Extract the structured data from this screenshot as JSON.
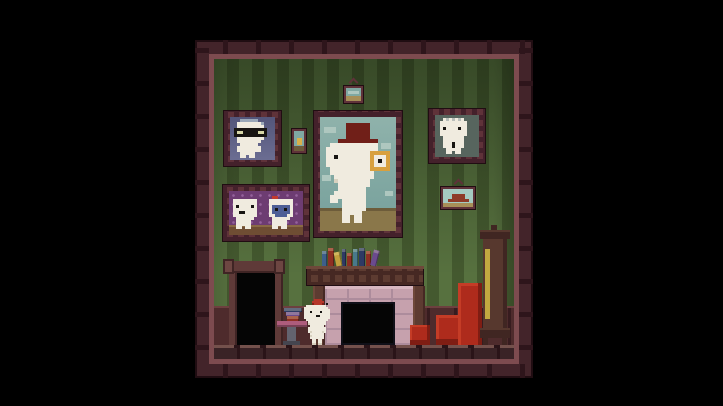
{
  "scene": {
    "game": "pixel-art platformer living room",
    "objects": [
      "room-frame",
      "striped-wallpaper",
      "wainscot",
      "plank-floor",
      "doorway",
      "portrait-grandfather-glasses",
      "portrait-ancestor-tophat-monocle",
      "portrait-couple",
      "portrait-elder",
      "small-picture-still-life",
      "small-picture-landscape-top",
      "small-picture-landscape-right",
      "fireplace",
      "mantel-books",
      "side-table",
      "table-books",
      "player-character-fez",
      "armchair",
      "ottoman",
      "grandfather-clock"
    ]
  },
  "palette": {
    "black": "#000000",
    "frameOuter": "#43242a",
    "frameStud": "#2e151b",
    "frameEdge": "#200d12",
    "trim": "#7d4b4f",
    "wallLight": "#57713f",
    "wallDark": "#44592f",
    "wainscot": "#4e2b2c",
    "wainscotTop": "#6d403f",
    "wainscotPost": "#371c1f",
    "floorTop": "#74514c",
    "floorBody": "#3a2326",
    "floorSeam": "#2a1418",
    "doorWood": "#5f3a38",
    "doorWoodLight": "#6d4642",
    "doorDark": "#3f2424",
    "opening": "#050505",
    "pFrame": "#5f3239",
    "pStud": "#44212b",
    "grandpaBgTop": "#53557a",
    "grandpaBgBot": "#6b6d92",
    "coupleBg": "#6d3c72",
    "coupleDot": "#95619c",
    "ledge": "#6f4d33",
    "ledgeTop": "#8a6a45",
    "oldmanBg": "#57655e",
    "skyTop": "#8fb2ab",
    "sky": "#76a09b",
    "cloud": "#aec7bf",
    "ground": "#8a774a",
    "groundDark": "#6d5c3a",
    "hat": "#701f18",
    "hatDark": "#541410",
    "monocle": "#d8a03e",
    "charWhite": "#f0ebdf",
    "charShade": "#d8d1bf",
    "ink": "#181512",
    "fezRed": "#b5372a",
    "fezDark": "#822019",
    "hairGrey": "#9aa7b8",
    "lensTint": "#d8d8a8",
    "oldHair": "#b9bdb9",
    "coupleBlue": "#4e5f96",
    "bowRed": "#c23b2e",
    "fireWood": "#5d3b31",
    "fireWoodDark": "#462823",
    "fireWoodLight": "#6e483a",
    "stone": "#c6a1ad",
    "stoneLine": "#ad8c9c",
    "stoneLight": "#d7b6c0",
    "chairRed": "#ae2b1c",
    "chairDark": "#7f1d13",
    "chairLight": "#c53c26",
    "clockWood": "#57382e",
    "clockDark": "#402622",
    "pendulum": "#c2a940",
    "tablePink": "#ad5c7c",
    "tableLeg": "#63636f",
    "tableBase": "#45454f",
    "bookBlue": "#3e5f8a",
    "bookRed": "#8e2f23",
    "bookYellow": "#c29f3d",
    "bookNavy": "#2e3a64",
    "bookPurple": "#6b4a8e",
    "bookTeal": "#49798a",
    "smallSky": "#7fa8a2",
    "smallGround": "#a78f58",
    "shipRed": "#8e3a28",
    "smallSkyLight": "#a5cac1",
    "pearYellow": "#d8b04a"
  },
  "mantel_books": [
    {
      "w": 5,
      "h": 15,
      "c": "bookBlue",
      "tilt": 0
    },
    {
      "w": 6,
      "h": 18,
      "c": "bookRed",
      "tilt": 0
    },
    {
      "w": 6,
      "h": 14,
      "c": "bookYellow",
      "tilt": -12
    },
    {
      "w": 4,
      "h": 17,
      "c": "bookNavy",
      "tilt": 0
    },
    {
      "w": 5,
      "h": 13,
      "c": "bookRed",
      "tilt": 0
    },
    {
      "w": 5,
      "h": 17,
      "c": "bookTeal",
      "tilt": 0
    },
    {
      "w": 6,
      "h": 18,
      "c": "bookNavy",
      "tilt": 0
    },
    {
      "w": 5,
      "h": 15,
      "c": "bookRed",
      "tilt": 0
    },
    {
      "w": 6,
      "h": 16,
      "c": "bookPurple",
      "tilt": 14
    }
  ],
  "table_books": [
    {
      "w": 18,
      "h": 4,
      "c": "bookNavy"
    },
    {
      "w": 14,
      "h": 4,
      "c": "bookPurple"
    },
    {
      "w": 12,
      "h": 5,
      "c": "bookRed"
    }
  ],
  "sprites": {
    "gomez": {
      "scale": 2,
      "colors": {
        "w": "charWhite",
        "W": "charShade",
        "r": "fezRed",
        "R": "fezDark",
        "k": "ink"
      },
      "rows": [
        ".....rrrr....",
        "....rrrrrr...",
        "....RrrrrR.k.",
        ".wwwwwwwwww..",
        "wwwwwwwwwwww.",
        "wwwwwwwwwwwww",
        "wwwkwwwwkwwww",
        "wwwwwwwwwwwww",
        "wwwwwwkkwwwww",
        "wwwwwwwwwwwww",
        ".wwwwwwwwwww.",
        "..wwwwwwwww..",
        "..Wwwwwwwww..",
        "...wwwwwww...",
        "..wwwwwwwww..",
        "..wwwwwwwww..",
        "..wWwwwwwWw..",
        "...wwwwwww...",
        "...Wwwwwww...",
        "...wwwwwww...",
        "....ww.ww....",
        "....ww.ww....",
        "....WW.WW...."
      ]
    },
    "ancestor": {
      "scale": 4,
      "colors": {
        "h": "hat",
        "w": "charWhite",
        "m": "monocle",
        "k": "ink",
        "S": "charShade"
      },
      "rows": [
        "......hhhhhh......",
        "......hhhhhh......",
        "......hhhhhh......",
        "......hhhhhh......",
        "....hhhhhhhhhh....",
        "..wwwwwwwwwwww....",
        ".wwwwwwwwwwwww....",
        ".wwwwwwwwwwwmmmmm.",
        ".wwkwwwwwwwwmwwwm.",
        ".wwwwwwwwwwwmwkwm.",
        ".wwwwwwwwwwwmwwwm.",
        "..wwwwwwwwwwmmmmm.",
        "..wwwwwwwwwww.....",
        "...wwwwwwwwww.....",
        "...Swwwwwwww......",
        "....wwwwwwww......",
        "....wwwwwww.......",
        "...wwwwwwww.......",
        "..wwwwwwwww.......",
        "..ww.wwwwww.......",
        ".....wwwwww.......",
        ".....wwwwww.......",
        ".....wwwww........",
        ".....ww.ww........",
        ".....ww.ww........"
      ]
    },
    "grandpa": {
      "scale": 3,
      "colors": {
        "w": "charWhite",
        "g": "hairGrey",
        "k": "ink",
        "e": "lensTint"
      },
      "rows": [
        "...gggggg.....",
        "..wwwwwwwwg...",
        "..wwwwwwwww...",
        ".kkkkkkkkkkk..",
        ".keekkkkkeek..",
        ".kkkkkkkkkkk..",
        "..wwwwwwwww...",
        "..wwwwwwww....",
        "...wwwwww.....",
        "..wwwwwwww....",
        "..wwwwwwww....",
        "...wwwww......",
        "...ww.ww......"
      ]
    },
    "couple": {
      "scale": 3,
      "colors": {
        "w": "charWhite",
        "k": "ink",
        "b": "coupleBlue",
        "r": "bowRed"
      },
      "rows": [
        "..............rr........",
        ".wwwwwwww....wwwwwwww...",
        ".wwwwwwww....wwwwwwww...",
        ".wkwwwwkw....wbbbbbbw...",
        ".wwwwwwww....wbkbbkbw...",
        ".wwkkwwww....wbbbbbbw...",
        ".wwwwwwww....wwbbbbww...",
        "..wwwwww......wwwwww....",
        "..wwwww.......wwwww.....",
        "..wwwww.......wwwww.....",
        "..ww.ww.......ww.ww....."
      ]
    },
    "elder": {
      "scale": 3,
      "colors": {
        "w": "charWhite",
        "g": "oldHair",
        "k": "ink"
      },
      "rows": [
        "..wgwgwgw....",
        ".wwwwwwwww...",
        ".wwwwwwwww...",
        ".wkwwwwkww...",
        ".wwwwwwwww...",
        ".wwwwwwwww...",
        "..wwwwwww....",
        "..wwwwwww....",
        "..wwwkwww....",
        "..wwwkwww....",
        "...wwwww.....",
        "...ww.ww....."
      ]
    }
  }
}
